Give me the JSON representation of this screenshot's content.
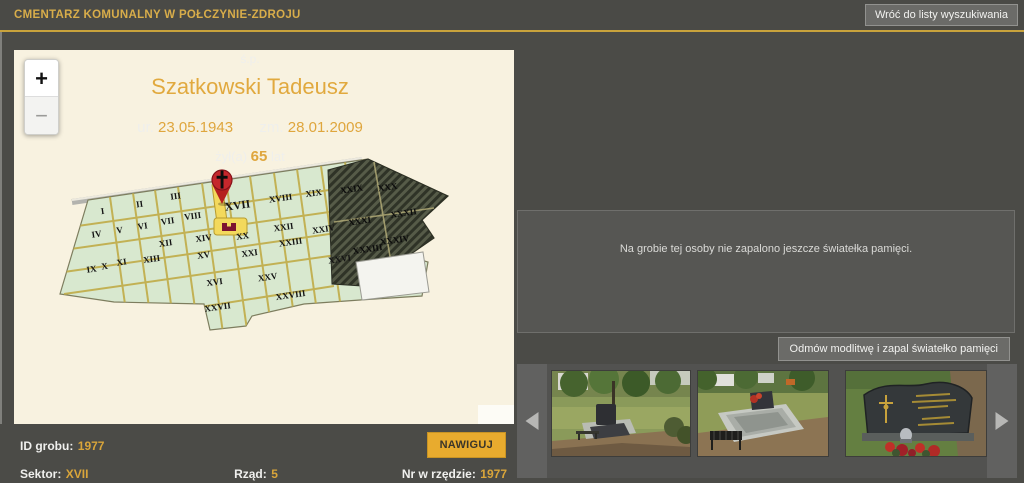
{
  "header": {
    "title": "CMENTARZ KOMUNALNY W POŁCZYNIE-ZDROJU",
    "back_button": "Wróć do listy wyszukiwania"
  },
  "person": {
    "honorific": "ś.p.",
    "name": "Szatkowski Tadeusz",
    "born_label": "ur.",
    "born_date": "23.05.1943",
    "died_label": "zm.",
    "died_date": "28.01.2009",
    "lived_label": "żył(a)",
    "lived_years": "65",
    "lived_suffix": "lat"
  },
  "memorial": {
    "empty_message": "Na grobie tej osoby nie zapalono jeszcze światełka pamięci.",
    "pray_button": "Odmów modlitwę i zapal światełko pamięci"
  },
  "grave_info": {
    "id_label": "ID grobu:",
    "id_value": "1977",
    "sector_label": "Sektor:",
    "sector_value": "XVII",
    "row_label": "Rząd:",
    "row_value": "5",
    "number_label": "Nr w rzędzie:",
    "number_value": "1977",
    "navigate_button": "NAWIGUJ"
  },
  "map_panel": {
    "zoom_in": "+",
    "zoom_out": "−",
    "marker_sector": "XVII",
    "sectors": [
      {
        "label": "I",
        "x": 89,
        "y": 164
      },
      {
        "label": "II",
        "x": 126,
        "y": 157
      },
      {
        "label": "III",
        "x": 162,
        "y": 149
      },
      {
        "label": "XVII",
        "x": 224,
        "y": 159,
        "big": true
      },
      {
        "label": "XVIII",
        "x": 267,
        "y": 151
      },
      {
        "label": "XIX",
        "x": 300,
        "y": 146
      },
      {
        "label": "XXIX",
        "x": 338,
        "y": 142,
        "dark": true
      },
      {
        "label": "XXX",
        "x": 374,
        "y": 140,
        "dark": true
      },
      {
        "label": "IV",
        "x": 83,
        "y": 187
      },
      {
        "label": "V",
        "x": 106,
        "y": 183
      },
      {
        "label": "VI",
        "x": 129,
        "y": 179
      },
      {
        "label": "VII",
        "x": 154,
        "y": 174
      },
      {
        "label": "VIII",
        "x": 179,
        "y": 169
      },
      {
        "label": "XXII",
        "x": 270,
        "y": 180
      },
      {
        "label": "XXIV",
        "x": 310,
        "y": 182
      },
      {
        "label": "XXXI",
        "x": 346,
        "y": 174,
        "dark": true
      },
      {
        "label": "XXXII",
        "x": 390,
        "y": 166,
        "dark": true
      },
      {
        "label": "XII",
        "x": 152,
        "y": 196
      },
      {
        "label": "XIV",
        "x": 190,
        "y": 191
      },
      {
        "label": "XX",
        "x": 229,
        "y": 189
      },
      {
        "label": "XXIII",
        "x": 277,
        "y": 195
      },
      {
        "label": "XXXIV",
        "x": 381,
        "y": 193,
        "dark": true
      },
      {
        "label": "IX",
        "x": 78,
        "y": 222
      },
      {
        "label": "X",
        "x": 91,
        "y": 219
      },
      {
        "label": "XI",
        "x": 108,
        "y": 215
      },
      {
        "label": "XIII",
        "x": 138,
        "y": 212
      },
      {
        "label": "XV",
        "x": 190,
        "y": 208
      },
      {
        "label": "XXI",
        "x": 236,
        "y": 206
      },
      {
        "label": "XXVI",
        "x": 326,
        "y": 212
      },
      {
        "label": "XXXIII",
        "x": 354,
        "y": 202,
        "dark": true
      },
      {
        "label": "XVI",
        "x": 201,
        "y": 235
      },
      {
        "label": "XXV",
        "x": 254,
        "y": 230
      },
      {
        "label": "XXVIII",
        "x": 277,
        "y": 248
      },
      {
        "label": "XXVII",
        "x": 204,
        "y": 260
      }
    ]
  },
  "gallery": {
    "photos": [
      {
        "name": "grave-wide-park-view"
      },
      {
        "name": "grave-surround-with-bench"
      },
      {
        "name": "headstone-closeup-with-crucifix"
      }
    ]
  },
  "colors": {
    "accent_gold": "#d9a53a",
    "navigate_yellow": "#e8ab2e",
    "map_background": "#f8f2e0",
    "sector_green": "#d8e8cf",
    "path_olive": "#c1ae4d",
    "marker_red": "#c5272c"
  }
}
